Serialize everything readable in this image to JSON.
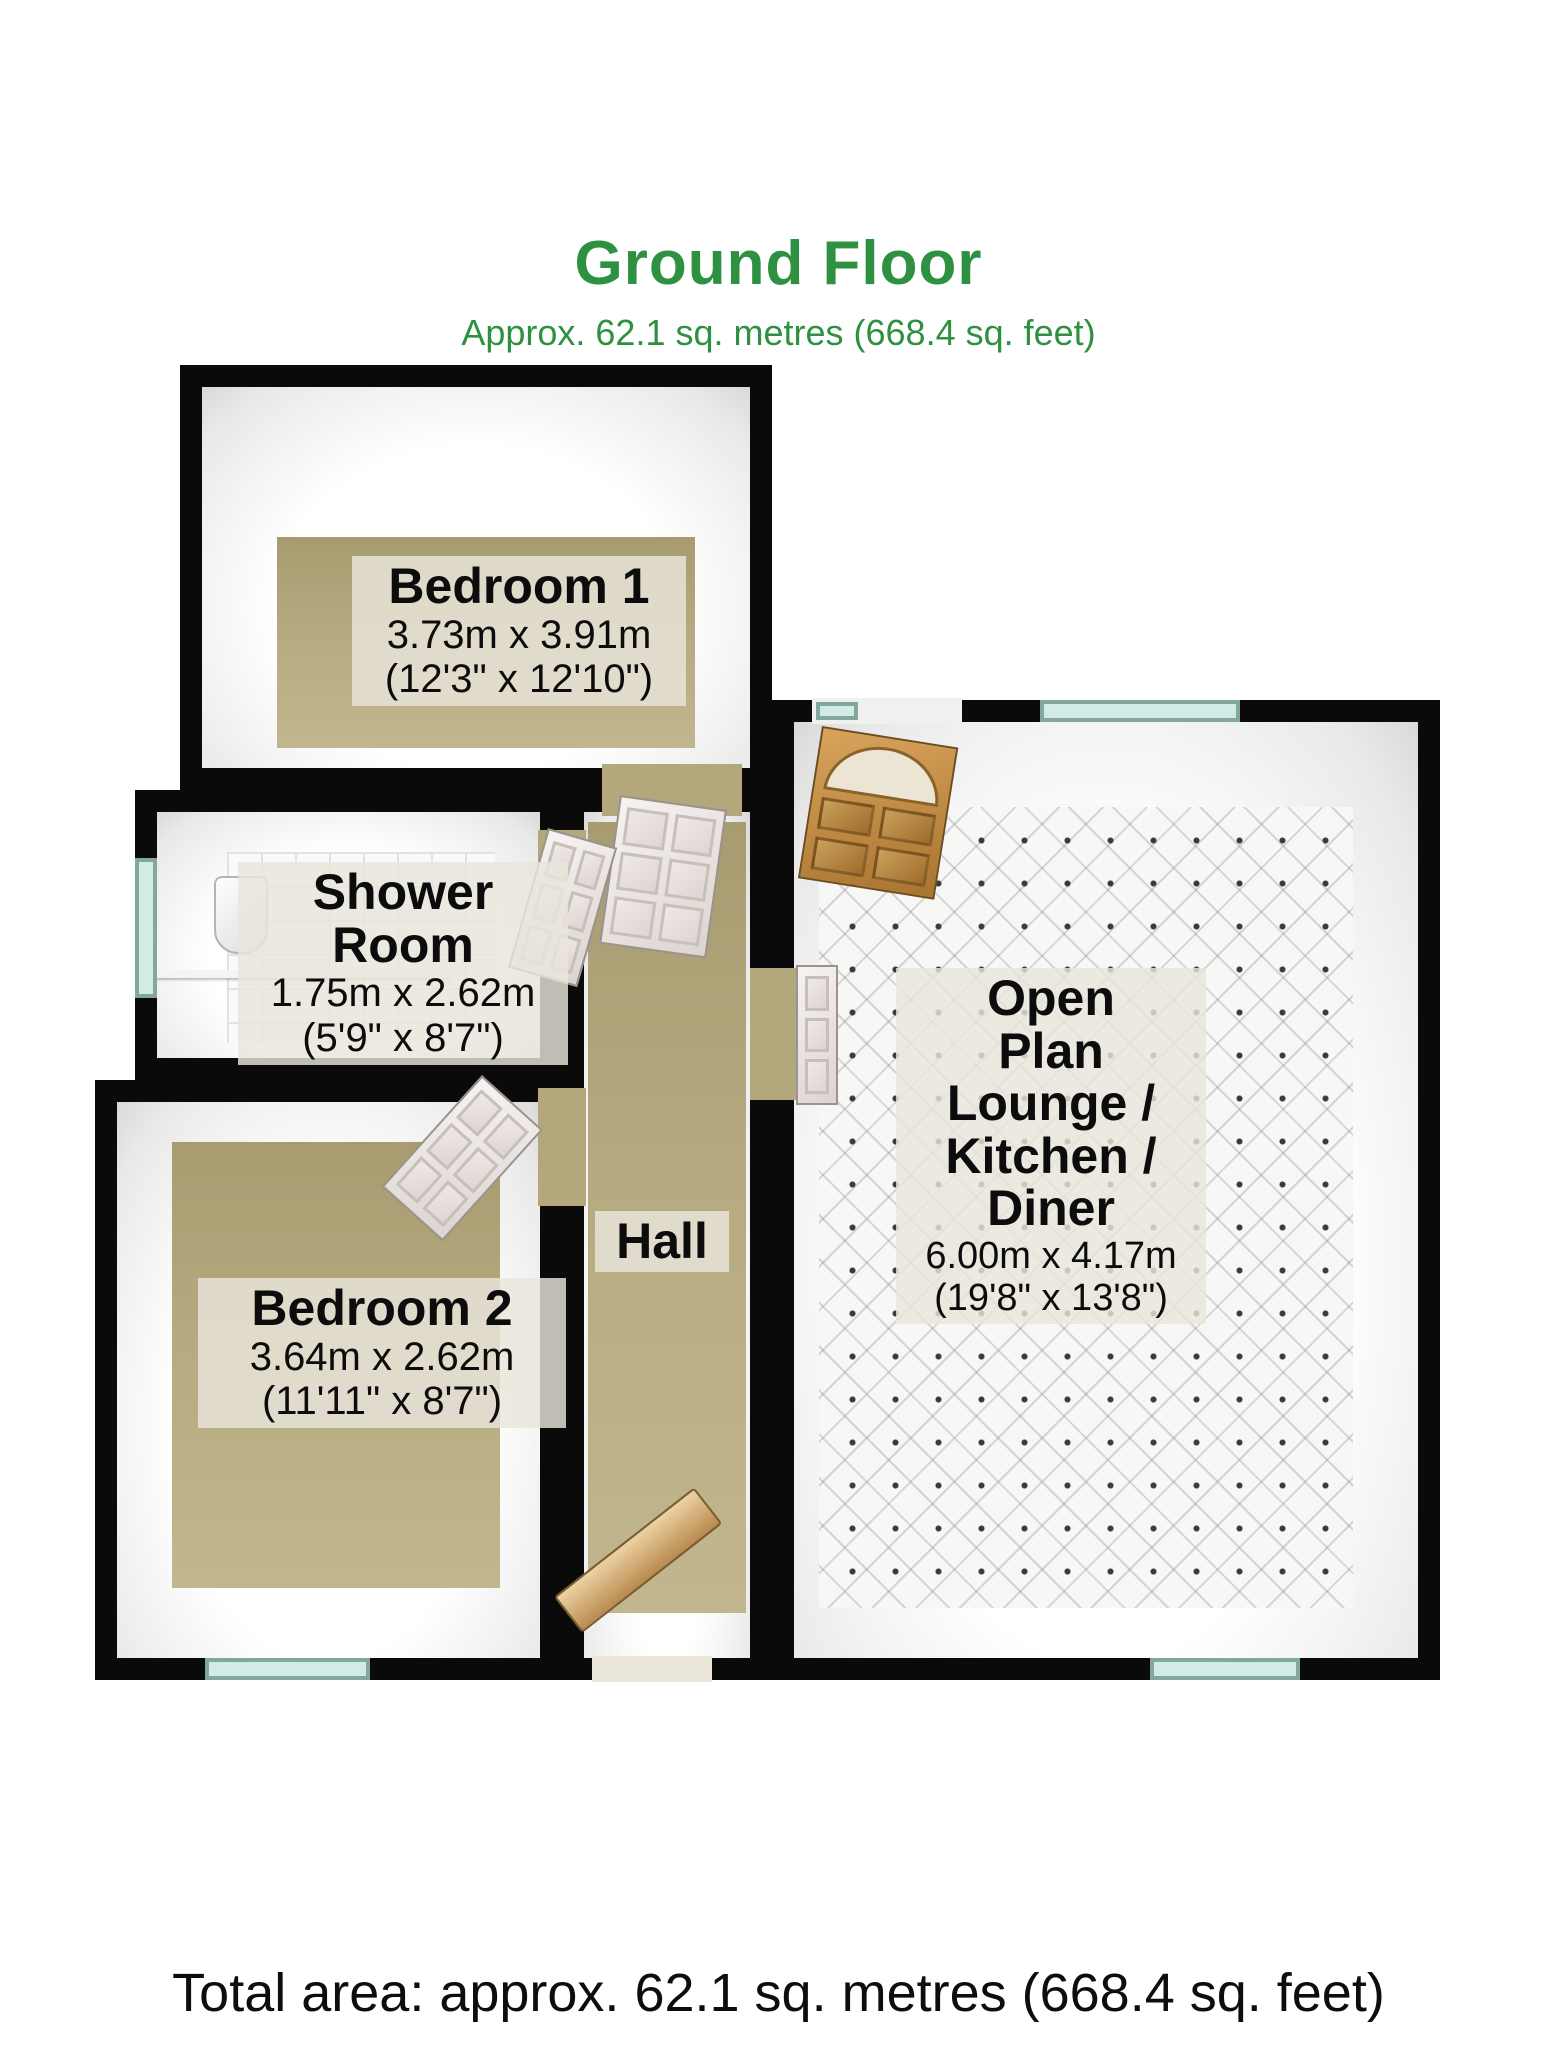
{
  "header": {
    "title": "Ground Floor",
    "subtitle": "Approx. 62.1 sq. metres (668.4 sq. feet)"
  },
  "footer": {
    "total_area": "Total area: approx. 62.1 sq. metres (668.4 sq. feet)"
  },
  "colors": {
    "title_green": "#2e9142",
    "wall_black": "#0a0a0a",
    "carpet_tan": "#b3a77c",
    "tile_white": "#fafafa",
    "window_teal": "#d2ebe4",
    "wood_door": "#b9873e",
    "label_background": "rgba(233,229,220,0.82)"
  },
  "rooms": [
    {
      "id": "bedroom1",
      "name": "Bedroom 1",
      "dims_metric": "3.73m x 3.91m",
      "dims_imperial": "(12'3\" x 12'10\")"
    },
    {
      "id": "shower",
      "name": "Shower Room",
      "dims_metric": "1.75m x 2.62m",
      "dims_imperial": "(5'9\" x 8'7\")"
    },
    {
      "id": "bedroom2",
      "name": "Bedroom 2",
      "dims_metric": "3.64m x 2.62m",
      "dims_imperial": "(11'11\" x 8'7\")"
    },
    {
      "id": "hall",
      "name": "Hall"
    },
    {
      "id": "openplan",
      "name": "Open Plan Lounge / Kitchen / Diner",
      "name_lines": [
        "Open",
        "Plan",
        "Lounge /",
        "Kitchen /",
        "Diner"
      ],
      "dims_metric": "6.00m x 4.17m",
      "dims_imperial": "(19'8\" x 13'8\")"
    }
  ]
}
